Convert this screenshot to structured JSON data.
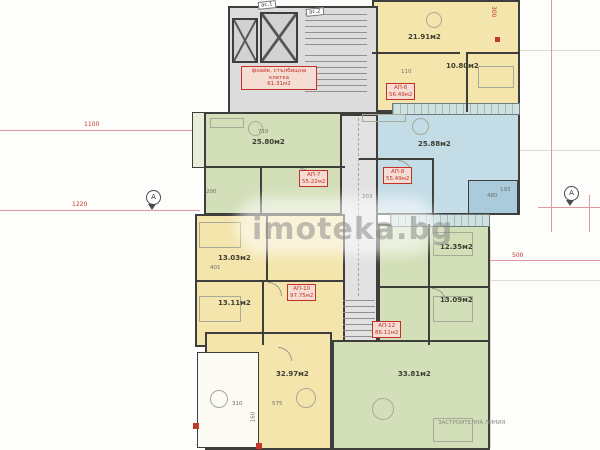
{
  "watermark": {
    "text": "imoteka.bg"
  },
  "colors": {
    "apartment_yellow": "#f4e5ad",
    "apartment_green": "#d3dfb8",
    "apartment_blue": "#c3dce6",
    "core_gray": "#dcdcdc",
    "label_red": "#c03226",
    "dimension_red": "#c0392b",
    "wall_dark": "#3e3e3c"
  },
  "core": {
    "foyer_line1": "фоайе, стълбищна",
    "foyer_line2": "клетка",
    "foyer_area": "61.31м2",
    "elevator1_tag": "ас.1",
    "elevator2_tag": "ас.2"
  },
  "apartments": {
    "top_right": {
      "tag": "АП-6",
      "area": "56.49м2",
      "living": "21.91м2",
      "bedroom": "10.80м2"
    },
    "mid_left": {
      "tag": "АП-7",
      "area": "55.22м2",
      "living": "25.80м2"
    },
    "mid_right": {
      "tag": "АП-8",
      "area": "55.49м2",
      "living": "25.88м2",
      "bath_dim": "480"
    },
    "lower_left": {
      "tag": "АП-10",
      "area": "97.75м2",
      "bedroom1": "13.03м2",
      "bedroom2": "13.11м2",
      "living": "32.97м2"
    },
    "lower_right": {
      "tag": "АП-12",
      "area": "86.11м2",
      "bedroom1": "12.35м2",
      "bedroom2": "13.09м2",
      "living": "33.81м2"
    }
  },
  "dimensions": {
    "red": [
      "1100",
      "1220",
      "300",
      "500"
    ],
    "gray": [
      "110",
      "710",
      "200",
      "401",
      "575",
      "310",
      "160",
      "203",
      "193"
    ]
  },
  "annotations": {
    "building_line": "ЗАСТРОИТЕЛНА ЛИНИЯ",
    "axis_left": "A",
    "axis_right": "A"
  }
}
